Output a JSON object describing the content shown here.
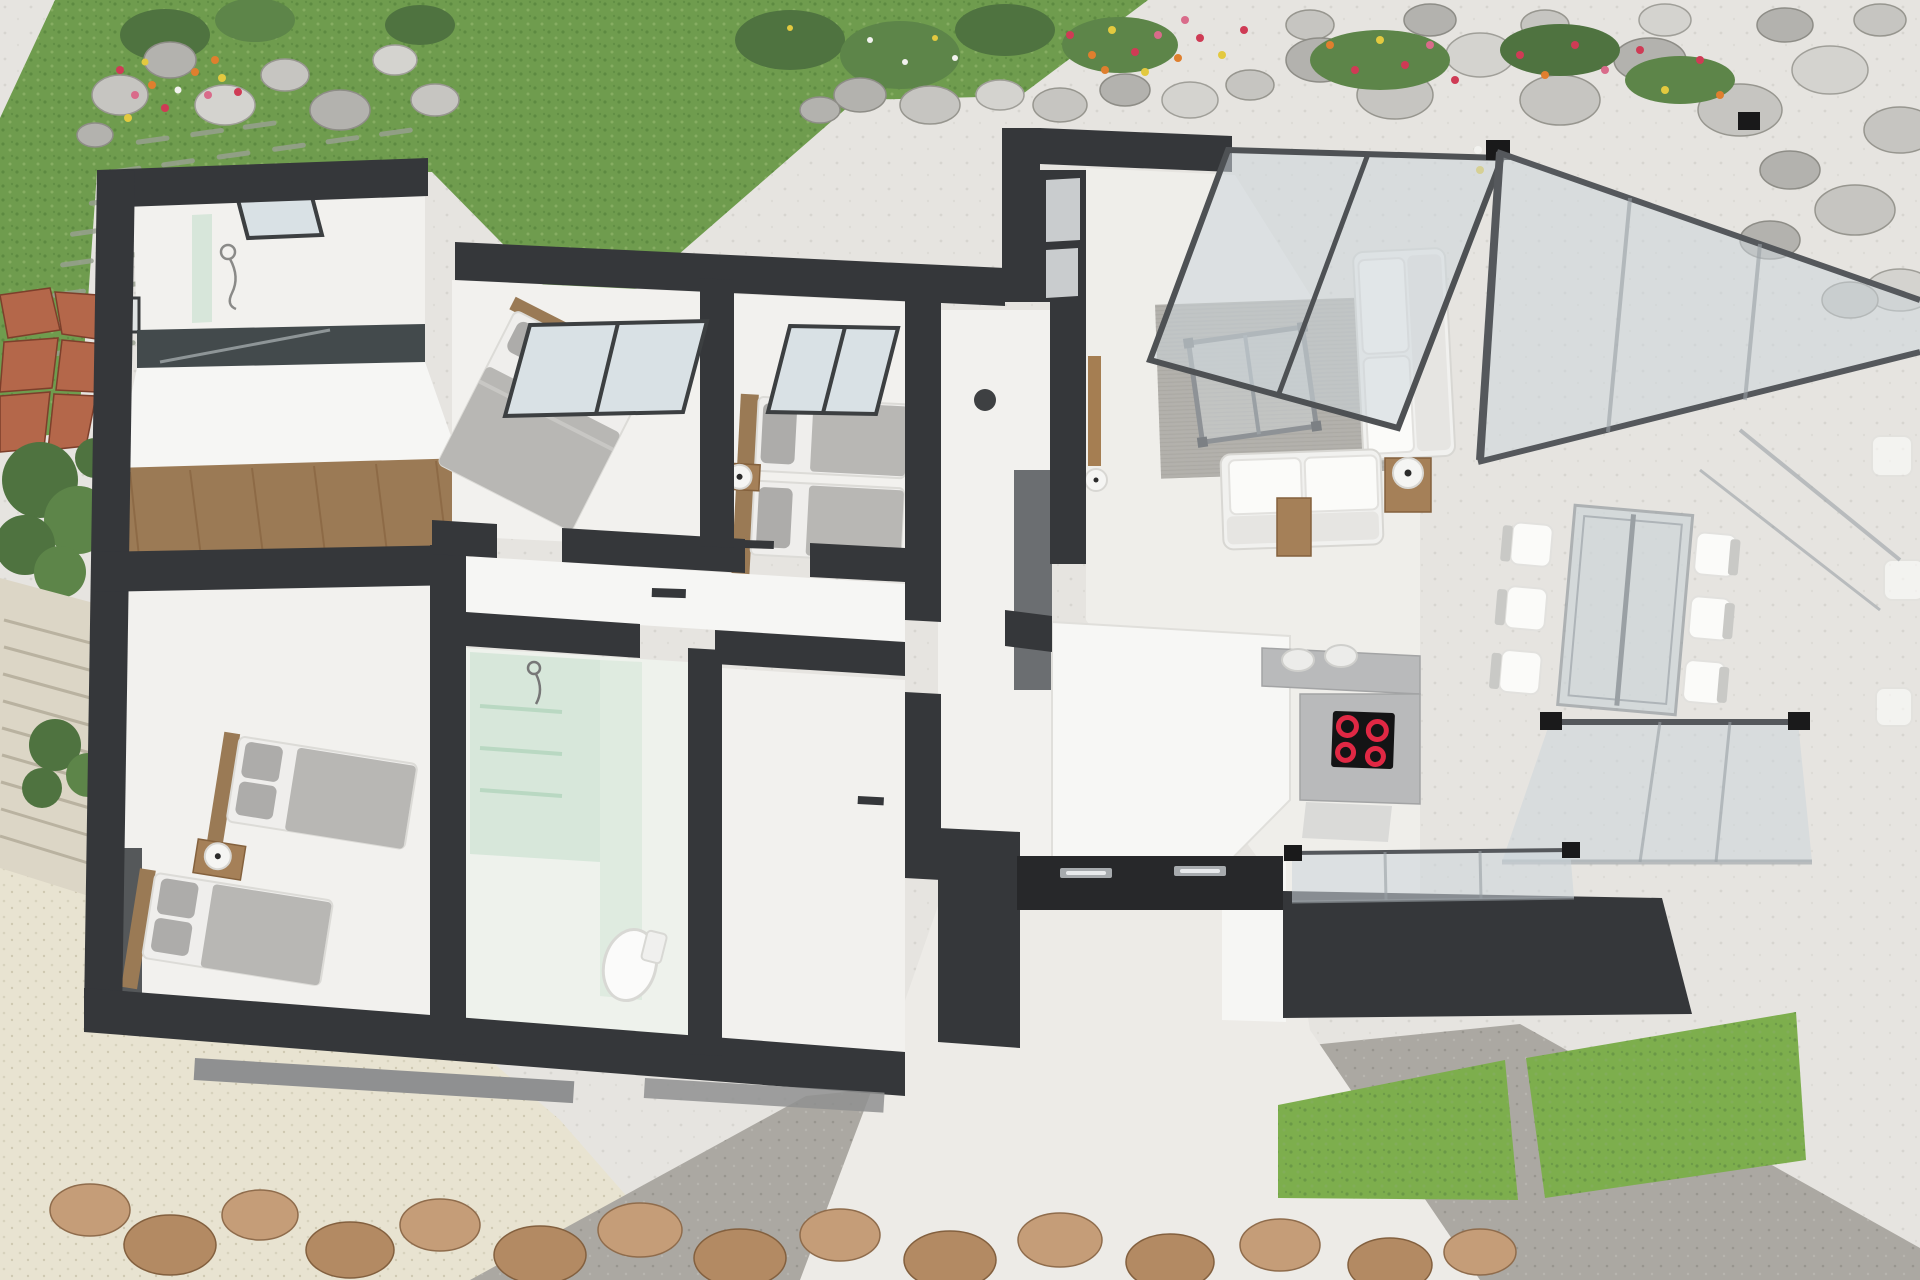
{
  "palette": {
    "wall": "#35373a",
    "wallsoft": "#6b6e71",
    "floor": "#f2f1ee",
    "woodfloor": "#9b7a55",
    "terrace": "#e6e4e0",
    "grass": "#6f9c4e",
    "grassbright": "#7dae4d",
    "gravel": "#e8e3d1",
    "driveway": "#aba8a2",
    "rockrust": "#b4674a",
    "glass": "#ccd5da",
    "glassframe": "#55585c",
    "greenglass": "#cfe3d4",
    "rug": "#b3b1ac",
    "sofa": "#f1f1ef",
    "bed": "#efeeec",
    "duvet": "#b8b7b4",
    "counter": "#b9babb",
    "stool": "#ececea",
    "cooktop": "#141415",
    "burner": "#e02844",
    "ceiling": "#27282a",
    "foliage": "#4f7340",
    "flowerred": "#cf3b55",
    "flowerorange": "#df7f2e",
    "floweryellow": "#e3c93f",
    "flowerpink": "#d96b8a"
  },
  "scene": {
    "rooms": {
      "bathroom_top": {
        "label": "bathroom with shower and skylight"
      },
      "hall": {
        "label": "entry hall with wood floor"
      },
      "bedroom_master": {
        "label": "bedroom with double bed"
      },
      "bedroom_twin": {
        "label": "bedroom with two single beds"
      },
      "bedroom_single": {
        "label": "bedroom with two single beds and wardrobe"
      },
      "bathroom_green": {
        "label": "bathroom with green glass shower and toilet"
      },
      "corridor": {
        "label": "corridor"
      },
      "hallway": {
        "label": "hallway with interior windows"
      },
      "living": {
        "label": "living room with sofas and glass coffee table"
      },
      "kitchen": {
        "label": "kitchen with induction cooktop and bar stools"
      },
      "dining": {
        "label": "glass dining conservatory with table and chairs"
      },
      "entrance": {
        "label": "entrance porch with recessed ceiling lights"
      }
    },
    "furniture_counts": {
      "beds": 5,
      "sofas": 2,
      "dining_chairs": 6,
      "bar_stools": 2,
      "cooktop_burners": 4,
      "table_lamps": 4,
      "coffee_tables": 1,
      "dining_tables": 1,
      "toilets": 1,
      "showers": 2,
      "skylight_windows": 3
    },
    "garden": {
      "flower_beds": 3,
      "rock_clusters": 3,
      "boulder_row": 1,
      "trees": 2,
      "grass_wedges": 2,
      "stone_steps": 1,
      "stepping_stone_path": 1
    }
  }
}
